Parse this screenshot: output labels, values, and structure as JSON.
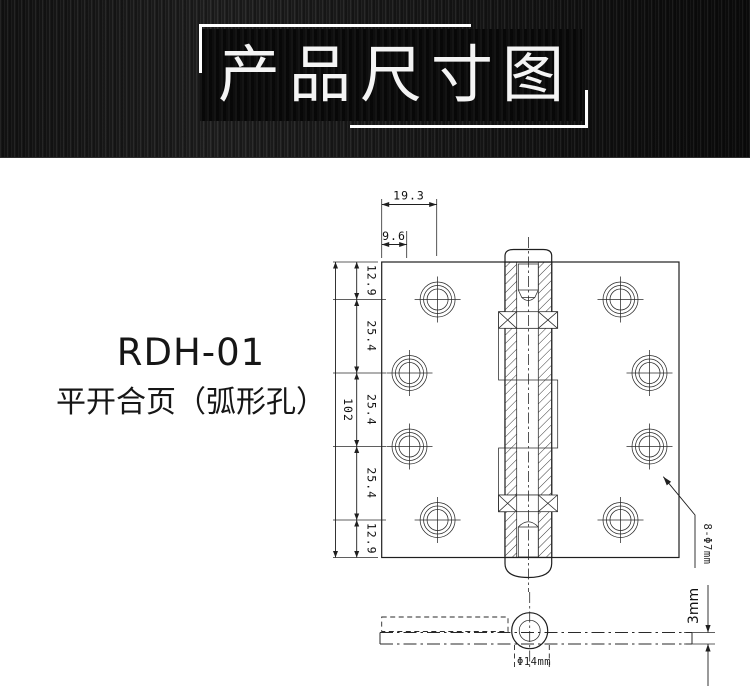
{
  "banner": {
    "title": "产品尺寸图"
  },
  "product": {
    "model": "RDH-01",
    "name": "平开合页（弧形孔）"
  },
  "drawing": {
    "dim_width_outer_hole": "19.3",
    "dim_width_inner_hole": "9.6",
    "dim_total_height": "102",
    "dim_segments": [
      "12.9",
      "25.4",
      "25.4",
      "25.4",
      "12.9"
    ],
    "hole_callout": "8-Φ7mm",
    "dim_thickness": "3mm",
    "dim_knuckle_diameter": "Φ14mm"
  }
}
